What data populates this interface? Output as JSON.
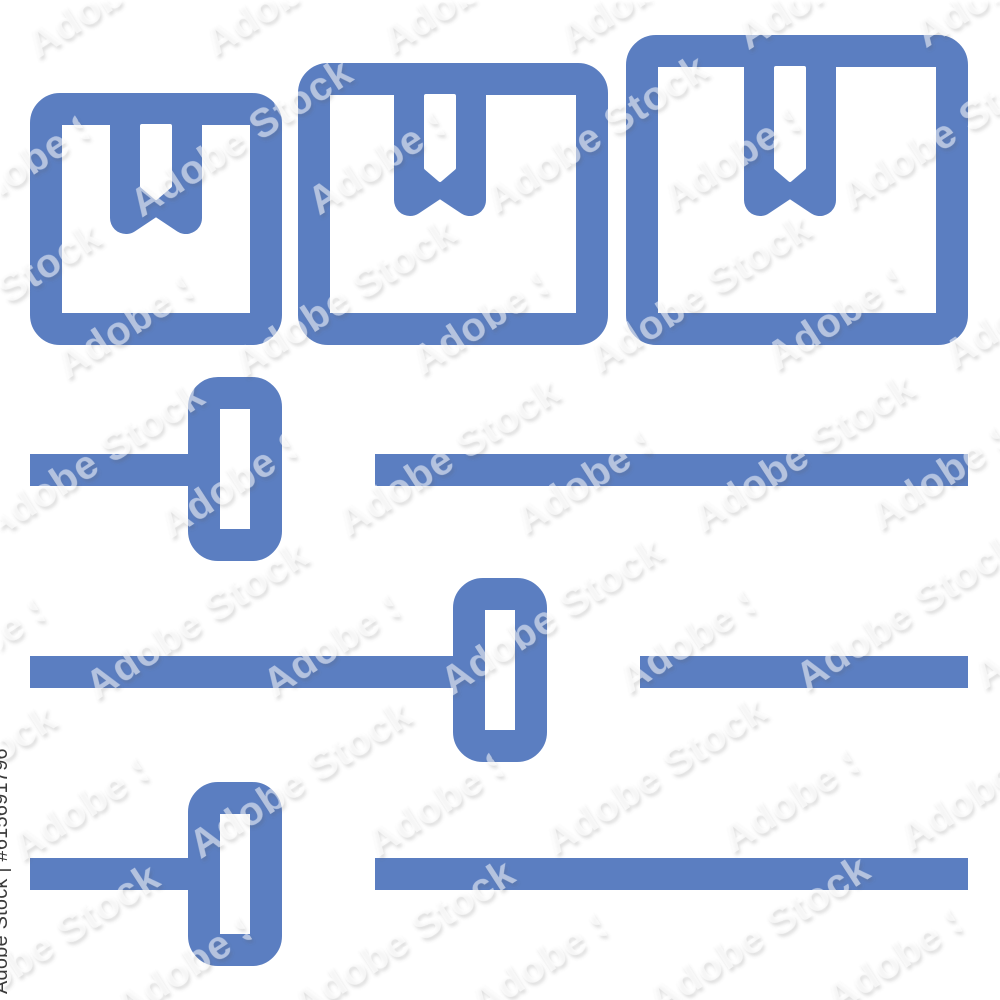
{
  "image": {
    "description": "Blue outline icon of three package boxes in increasing sizes above three horizontal slider controls, shown as a watermarked stock-image preview on a white background",
    "background": "#ffffff"
  },
  "css_vars": {
    "--icon-color": "#5b7ec1",
    "--label-color": "#3b3b3b",
    "--bg-color": "#ffffff"
  },
  "icon": {
    "parts": [
      "package-box-small",
      "package-box-medium",
      "package-box-large",
      "slider-top",
      "slider-middle",
      "slider-bottom"
    ]
  },
  "watermark": {
    "tile_text": "Adobe Stock",
    "label_text": "Adobe Stock | #615691796"
  }
}
